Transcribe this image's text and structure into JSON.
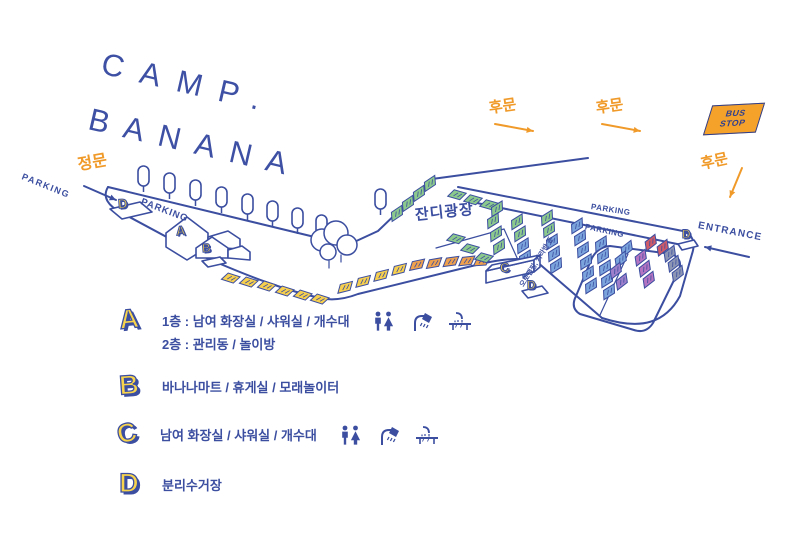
{
  "colors": {
    "blue": "#3B4EA0",
    "deep_blue": "#2E3F8F",
    "orange": "#F09A2A",
    "yellow": "#F8D44C",
    "white": "#FFFFFF",
    "tiles": {
      "y": "#F6CF4F",
      "o": "#EFA14D",
      "g": "#8CC98C",
      "b": "#7BA3DC",
      "p": "#9E7FCB",
      "m": "#B574C1",
      "r": "#CF5A68",
      "gy": "#8C96B4"
    }
  },
  "title": {
    "line1": "CAMP.",
    "line2": "BANANA"
  },
  "bus_stop": {
    "line1": "BUS",
    "line2": "STOP"
  },
  "labels": [
    {
      "name": "parking-west-label",
      "text": "PARKING",
      "x": 22,
      "y": 172,
      "rot": 22,
      "size": 9,
      "c": "blue",
      "ls": 1.5,
      "w": 600
    },
    {
      "name": "main-gate-label",
      "text": "정문",
      "x": 78,
      "y": 158,
      "rot": -10,
      "size": 16,
      "c": "orange",
      "ls": 0,
      "w": 800
    },
    {
      "name": "parking-northwest-label",
      "text": "PARKING",
      "x": 141,
      "y": 197,
      "rot": 21,
      "size": 9.5,
      "c": "blue",
      "ls": 1,
      "w": 700
    },
    {
      "name": "back-gate-label-1",
      "text": "후문",
      "x": 489,
      "y": 101,
      "rot": -8,
      "size": 15,
      "c": "orange",
      "ls": 0,
      "w": 800
    },
    {
      "name": "back-gate-label-2",
      "text": "후문",
      "x": 596,
      "y": 101,
      "rot": -8,
      "size": 15,
      "c": "orange",
      "ls": 0,
      "w": 800
    },
    {
      "name": "back-gate-label-3",
      "text": "후문",
      "x": 701,
      "y": 157,
      "rot": -12,
      "size": 15,
      "c": "orange",
      "ls": 0,
      "w": 800
    },
    {
      "name": "entrance-label",
      "text": "ENTRANCE",
      "x": 698,
      "y": 221,
      "rot": 11,
      "size": 10,
      "c": "blue",
      "ls": 1.2,
      "w": 600
    },
    {
      "name": "parking-east-label-1",
      "text": "PARKING",
      "x": 591,
      "y": 203,
      "rot": 9,
      "size": 8,
      "c": "blue",
      "ls": 0.5,
      "w": 600
    },
    {
      "name": "parking-east-label-2",
      "text": "PARKING",
      "x": 585,
      "y": 223,
      "rot": 12,
      "size": 8,
      "c": "blue",
      "ls": 0.5,
      "w": 600
    },
    {
      "name": "grass-plaza-label",
      "text": "잔디광장",
      "x": 415,
      "y": 208,
      "rot": -6,
      "size": 15,
      "c": "blue",
      "ls": 1,
      "w": 800
    },
    {
      "name": "zone-label",
      "text": "오토캠핑, 카라반 존",
      "x": 522,
      "y": 283,
      "rot": -58,
      "size": 7,
      "c": "blue",
      "ls": 0,
      "w": 600
    }
  ],
  "arrows": [
    {
      "name": "main-gate-arrow",
      "x1": 84,
      "y1": 186,
      "x2": 116,
      "y2": 200,
      "c": "blue"
    },
    {
      "name": "back-gate-arrow-1",
      "x1": 495,
      "y1": 124,
      "x2": 533,
      "y2": 131,
      "c": "orange"
    },
    {
      "name": "back-gate-arrow-2",
      "x1": 602,
      "y1": 124,
      "x2": 640,
      "y2": 131,
      "c": "orange"
    },
    {
      "name": "back-gate-arrow-3",
      "x1": 742,
      "y1": 168,
      "x2": 730,
      "y2": 197,
      "c": "orange"
    },
    {
      "name": "entrance-arrow",
      "x1": 749,
      "y1": 257,
      "x2": 705,
      "y2": 247,
      "c": "blue"
    }
  ],
  "map": {
    "roads": [
      "M108,187 L356,247",
      "M108,187 C102,197 108,206 122,213 L202,256 C252,278 288,291 320,298 C333,301 345,299 358,294 L472,266",
      "M352,243 L378,231 L432,179",
      "M432,179 L588,158",
      "M458,187 L688,232",
      "M472,202 L682,245",
      "M472,266 C500,259 518,257 536,261 L602,318",
      "M602,318 C642,331 666,322 680,296 L692,254 C696,242 692,234 684,232",
      "M610,246 Q598,247 592,258 L576,296 Q570,308 580,314 L634,330 Q646,334 653,323 L678,272 Q684,260 672,254 Z"
    ],
    "lines": [
      "M166,233 L187,224 L208,233",
      "M187,217 L187,224",
      "M196,248 L212,243 L228,248",
      "M212,237 L212,243",
      "M329,261 L329,268",
      "M341,255 L341,262",
      "M628,254 L600,315",
      "M436,248 L504,229 L518,260"
    ],
    "shapes": [
      {
        "name": "pad-d-west",
        "d": "M110,209 L140,202 L152,212 L122,219 Z"
      },
      {
        "name": "building-a-body",
        "d": "M166,233 L187,217 L208,233 L208,247 L187,260 L166,247 Z"
      },
      {
        "name": "building-a-wing",
        "d": "M208,237 L228,231 L240,239 L240,249 L208,247 Z"
      },
      {
        "name": "building-b-body",
        "d": "M196,248 L212,237 L228,248 L228,258 L196,258 Z"
      },
      {
        "name": "building-b-wing",
        "d": "M228,250 L242,246 L250,252 L250,260 L228,258 Z"
      },
      {
        "name": "empty-pad",
        "d": "M202,261 L220,257 L226,263 L208,267 Z"
      },
      {
        "name": "building-c-front",
        "d": "M486,271 L534,260 L534,272 L486,283 Z"
      },
      {
        "name": "building-c-top",
        "d": "M486,271 L492,265 L540,255 L534,260 Z"
      },
      {
        "name": "building-c-side",
        "d": "M534,260 L540,255 L540,267 L534,272 Z"
      },
      {
        "name": "pad-d-center",
        "d": "M522,291 L542,286 L548,293 L528,298 Z"
      },
      {
        "name": "pad-d-east",
        "d": "M678,244 L694,240 L698,246 L682,250 Z"
      }
    ],
    "trees": [
      [
        138,
        166
      ],
      [
        164,
        173
      ],
      [
        190,
        180
      ],
      [
        216,
        187
      ],
      [
        242,
        194
      ],
      [
        267,
        201
      ],
      [
        292,
        208
      ],
      [
        316,
        215
      ],
      [
        375,
        189
      ]
    ],
    "bushes": [
      [
        322,
        240,
        11
      ],
      [
        336,
        233,
        12
      ],
      [
        347,
        245,
        10
      ],
      [
        328,
        252,
        8
      ]
    ],
    "tiles": [
      [
        222,
        271,
        18,
        "y"
      ],
      [
        240,
        275,
        18,
        "y"
      ],
      [
        258,
        279,
        18,
        "y"
      ],
      [
        276,
        284,
        18,
        "y"
      ],
      [
        294,
        288,
        18,
        "y"
      ],
      [
        311,
        292,
        18,
        "y"
      ],
      [
        334,
        286,
        -14,
        "y"
      ],
      [
        352,
        280,
        -14,
        "y"
      ],
      [
        370,
        274,
        -14,
        "y"
      ],
      [
        388,
        268,
        -14,
        "y"
      ],
      [
        406,
        263,
        -12,
        "o"
      ],
      [
        423,
        261,
        -10,
        "o"
      ],
      [
        440,
        259,
        -8,
        "o"
      ],
      [
        456,
        258,
        -6,
        "o"
      ],
      [
        471,
        258,
        -4,
        "o"
      ],
      [
        386,
        216,
        -34,
        "g"
      ],
      [
        397,
        206,
        -34,
        "g"
      ],
      [
        408,
        196,
        -34,
        "g"
      ],
      [
        419,
        186,
        -34,
        "g"
      ],
      [
        448,
        188,
        16,
        "g"
      ],
      [
        464,
        193,
        16,
        "g"
      ],
      [
        480,
        198,
        16,
        "g"
      ],
      [
        486,
        211,
        -32,
        "g"
      ],
      [
        482,
        223,
        -32,
        "g"
      ],
      [
        485,
        236,
        -32,
        "g"
      ],
      [
        488,
        249,
        -32,
        "g"
      ],
      [
        447,
        232,
        16,
        "g"
      ],
      [
        461,
        242,
        16,
        "g"
      ],
      [
        475,
        251,
        16,
        "g"
      ],
      [
        506,
        224,
        -32,
        "g"
      ],
      [
        509,
        236,
        -32,
        "g"
      ],
      [
        536,
        220,
        -32,
        "g"
      ],
      [
        538,
        232,
        -32,
        "g"
      ],
      [
        512,
        248,
        -32,
        "b"
      ],
      [
        514,
        260,
        -32,
        "b"
      ],
      [
        517,
        272,
        -32,
        "b"
      ],
      [
        541,
        244,
        -32,
        "b"
      ],
      [
        543,
        256,
        -32,
        "b"
      ],
      [
        545,
        268,
        -32,
        "b"
      ],
      [
        566,
        228,
        -32,
        "b"
      ],
      [
        569,
        240,
        -32,
        "b"
      ],
      [
        572,
        252,
        -32,
        "b"
      ],
      [
        575,
        264,
        -32,
        "b"
      ],
      [
        577,
        276,
        -32,
        "b"
      ],
      [
        580,
        288,
        -32,
        "b"
      ],
      [
        590,
        246,
        -32,
        "b"
      ],
      [
        592,
        258,
        -32,
        "b"
      ],
      [
        594,
        270,
        -32,
        "b"
      ],
      [
        596,
        282,
        -32,
        "b"
      ],
      [
        598,
        294,
        -32,
        "b"
      ],
      [
        616,
        252,
        -38,
        "b"
      ],
      [
        610,
        263,
        -38,
        "b"
      ],
      [
        605,
        274,
        -38,
        "p"
      ],
      [
        611,
        285,
        -38,
        "p"
      ],
      [
        640,
        246,
        -38,
        "r"
      ],
      [
        652,
        251,
        -38,
        "r"
      ],
      [
        630,
        261,
        -38,
        "m"
      ],
      [
        634,
        272,
        -38,
        "m"
      ],
      [
        638,
        283,
        -38,
        "m"
      ],
      [
        659,
        257,
        -38,
        "gy"
      ],
      [
        663,
        267,
        -38,
        "gy"
      ],
      [
        667,
        277,
        -38,
        "gy"
      ]
    ],
    "markers": [
      {
        "letter": "D",
        "x": 118,
        "y": 197,
        "rot": -4,
        "s": 13
      },
      {
        "letter": "A",
        "x": 176,
        "y": 224,
        "rot": -4,
        "s": 13
      },
      {
        "letter": "B",
        "x": 202,
        "y": 242,
        "rot": -4,
        "s": 12
      },
      {
        "letter": "C",
        "x": 500,
        "y": 261,
        "rot": -8,
        "s": 13
      },
      {
        "letter": "D",
        "x": 527,
        "y": 279,
        "rot": 0,
        "s": 12
      },
      {
        "letter": "D",
        "x": 682,
        "y": 228,
        "rot": 0,
        "s": 12
      }
    ]
  },
  "legend": {
    "a": {
      "letter": "A",
      "line1": "1층 : 남여 화장실 / 샤워실 / 개수대",
      "line2": "2층 : 관리동 / 놀이방"
    },
    "b": {
      "letter": "B",
      "line1": "바나나마트 / 휴게실 / 모래놀이터"
    },
    "c": {
      "letter": "C",
      "line1": "남여 화장실 / 샤워실 / 개수대"
    },
    "d": {
      "letter": "D",
      "line1": "분리수거장"
    }
  }
}
